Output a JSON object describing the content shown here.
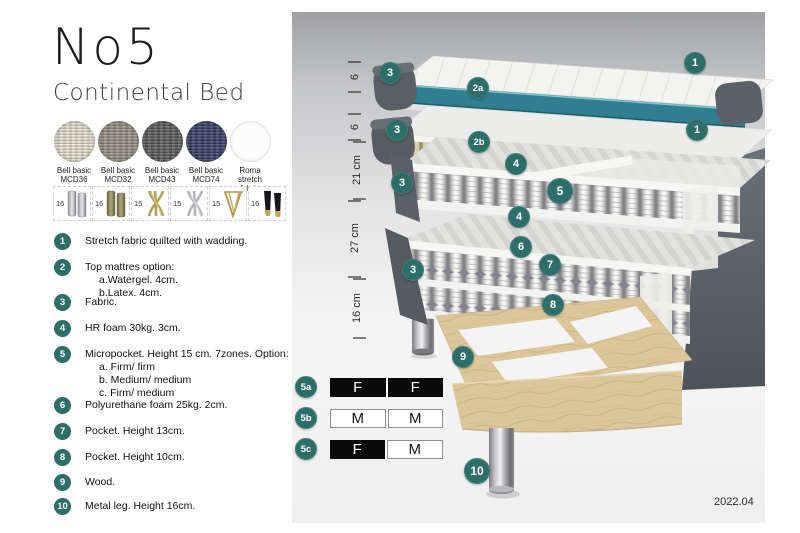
{
  "product": {
    "name": "No5",
    "type": "Continental Bed",
    "version": "2022.04"
  },
  "fabrics": [
    {
      "line1": "Bell basic",
      "line2": "MCD36"
    },
    {
      "line1": "Bell basic",
      "line2": "MCD32"
    },
    {
      "line1": "Bell basic",
      "line2": "MCD43"
    },
    {
      "line1": "Bell basic",
      "line2": "MCD74"
    },
    {
      "line1": "Roma",
      "line2": "stretch fabric"
    }
  ],
  "legs": [
    {
      "height": "16",
      "style": "cylinder-silver"
    },
    {
      "height": "16",
      "style": "cylinder-olive"
    },
    {
      "height": "15",
      "style": "cross-gold"
    },
    {
      "height": "15",
      "style": "cross-silver"
    },
    {
      "height": "15",
      "style": "hairpin-gold"
    },
    {
      "height": "16",
      "style": "taper-black-gold"
    }
  ],
  "features": [
    {
      "num": "1",
      "text": "Stretch fabric quilted with wadding."
    },
    {
      "num": "2",
      "text": "Top mattres option:",
      "sub": [
        "a.Watergel. 4cm.",
        "b.Latex. 4cm."
      ]
    },
    {
      "num": "3",
      "text": "Fabric."
    },
    {
      "num": "4",
      "text": "HR foam 30kg. 3cm."
    },
    {
      "num": "5",
      "text": "Micropocket. Height 15 cm. 7zones. Option:",
      "sub": [
        "a. Firm/ firm",
        "b. Medium/ medium",
        "c. Firm/ medium"
      ]
    },
    {
      "num": "6",
      "text": "Polyurethane foam 25kg. 2cm."
    },
    {
      "num": "7",
      "text": "Pocket. Height 13cm."
    },
    {
      "num": "8",
      "text": "Pocket. Height 10cm."
    },
    {
      "num": "9",
      "text": "Wood."
    },
    {
      "num": "10",
      "text": "Metal leg. Height 16cm."
    }
  ],
  "diagram": {
    "scale": [
      {
        "label": "6"
      },
      {
        "label": "6"
      },
      {
        "label": "21 cm"
      },
      {
        "label": "27 cm"
      },
      {
        "label": "16 cm"
      }
    ],
    "badges": [
      {
        "label": "3"
      },
      {
        "label": "1"
      },
      {
        "label": "2a"
      },
      {
        "label": "3"
      },
      {
        "label": "2b"
      },
      {
        "label": "1"
      },
      {
        "label": "4"
      },
      {
        "label": "5"
      },
      {
        "label": "4"
      },
      {
        "label": "3"
      },
      {
        "label": "6"
      },
      {
        "label": "7"
      },
      {
        "label": "8"
      },
      {
        "label": "3"
      },
      {
        "label": "9"
      },
      {
        "label": "10"
      }
    ],
    "firmness": [
      {
        "id": "5a",
        "cells": [
          {
            "v": "F",
            "filled": true
          },
          {
            "v": "F",
            "filled": true
          }
        ]
      },
      {
        "id": "5b",
        "cells": [
          {
            "v": "M",
            "filled": false
          },
          {
            "v": "M",
            "filled": false
          }
        ]
      },
      {
        "id": "5c",
        "cells": [
          {
            "v": "F",
            "filled": true
          },
          {
            "v": "M",
            "filled": false
          }
        ]
      }
    ]
  },
  "colors": {
    "badge_teal": "#2d6e6a",
    "layer_teal": "#2f7f90",
    "latex_khaki": "#d5d0a7",
    "wood": "#dcc79b",
    "dark_gray_fabric": "#575b63",
    "firm_black": "#0a0a0a"
  }
}
